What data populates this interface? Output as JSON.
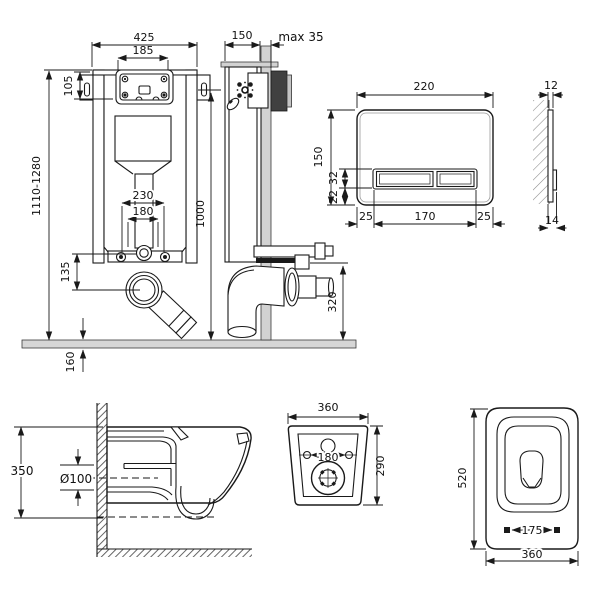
{
  "title": "Wall-hung toilet installation set - dimensional drawing",
  "colors": {
    "line": "#1a1a1a",
    "floor_gray": "#d6d6d6",
    "wall_gray": "#d2d2d2",
    "dark_block": "#404040",
    "light_block": "#c4c4c4",
    "background": "#ffffff"
  },
  "views": {
    "frame_front": {
      "dims": {
        "overall_width": "425",
        "window_width": "185",
        "bracket_height": "105",
        "frame_height_range": "1110-1280",
        "fixing_spacing": "230",
        "drain_spacing": "180",
        "valve_to_drain": "135",
        "floor_depth": "160"
      }
    },
    "frame_side": {
      "dims": {
        "depth": "150",
        "wall_max": "max 35",
        "height": "1000",
        "outlet_height": "320"
      }
    },
    "flush_plate": {
      "dims": {
        "width": "220",
        "height": "150",
        "button_height": "32",
        "button_offset": "22",
        "margin_left": "25",
        "buttons_width": "170",
        "margin_right": "25"
      }
    },
    "flush_plate_profile": {
      "dims": {
        "top_thickness": "12",
        "bottom_thickness": "14"
      }
    },
    "bowl_side": {
      "dims": {
        "height": "350",
        "outlet_diameter": "Ø100"
      }
    },
    "bowl_rear": {
      "dims": {
        "width": "360",
        "hole_spacing": "180",
        "height": "290"
      }
    },
    "bowl_top": {
      "dims": {
        "depth": "520",
        "seat_hole_spacing": "175",
        "width": "360"
      }
    }
  }
}
